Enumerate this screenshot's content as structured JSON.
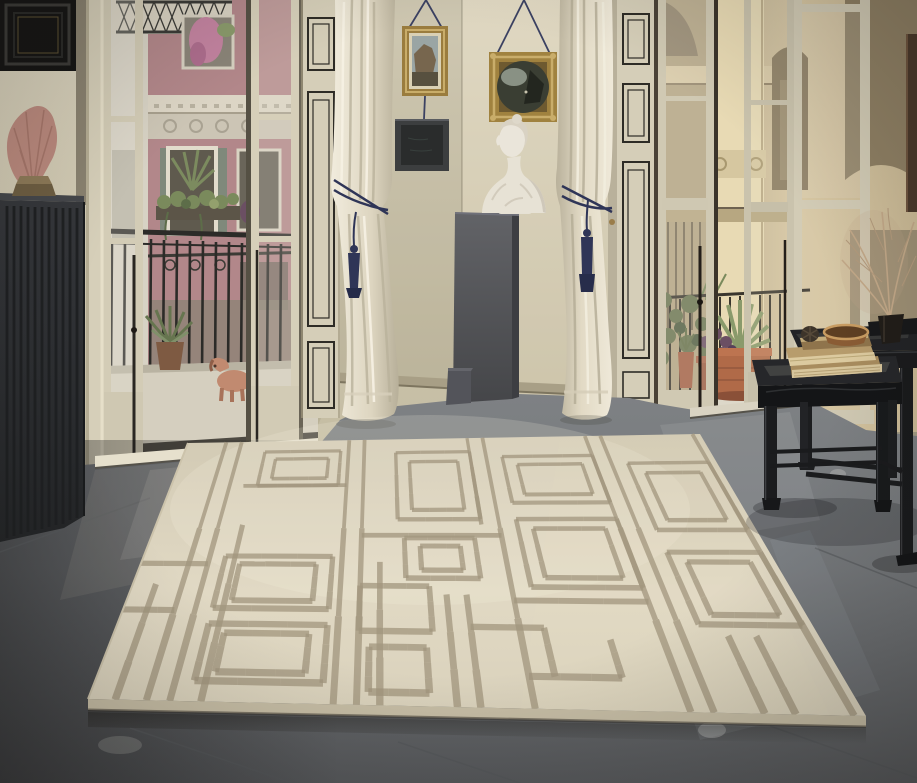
{
  "scene": {
    "description": "Sunlit historic apartment interior: tall open french doors reveal street balconies on the left (pink facade, plants, a ceramic dog figurine) and a baroque sandstone building on the right. A cream wool rug with a raised taupe architectural grid pattern lies on a polished grey stone floor. In the corner alcove, two gold-framed paintings and a dark plaque hang on cords above a white marble bust on a grey pedestal, flanked by ivory curtains tied with navy tassels. At right, black nesting side tables hold antique books, a wooden bowl and a dried sea-fan branch.",
    "objects": [
      "patterned cream rug",
      "polished grey stone floor",
      "french doors with black-trimmed cream panels",
      "ivory curtains with navy tassel tiebacks",
      "gold framed landscape painting",
      "gold framed round painting",
      "dark slate plaque",
      "white marble bust",
      "grey pedestal",
      "pink sea-fan coral on wood base",
      "dark ribbed sideboard",
      "black ornate picture frame",
      "street balcony with iron railing",
      "ceramic dog figurine",
      "terracotta planters with agave",
      "black nesting tables",
      "stack of antique books",
      "wooden bowl",
      "pinecone",
      "dried sea-fan branch in dark vase",
      "pink residential facade",
      "baroque sandstone facade"
    ]
  },
  "palette": {
    "wall": "#d5cdb5",
    "wallShade": "#bdb49a",
    "cream": "#d6cfb9",
    "creamLit": "#e5dfc9",
    "trim": "#2e2c26",
    "curtain": "#eee8d8",
    "curtainShade": "#c2ba a4",
    "navy": "#2f3557",
    "gold": "#9e8040",
    "goldLit": "#c9ad6a",
    "plaque": "#3c3e3f",
    "bust": "#eae5da",
    "pedestal": "#57585c",
    "cabinet": "#2f3133",
    "coral": "#bb8a7e",
    "woodBase": "#8d7a58",
    "floor": "#797c7f",
    "floorDark": "#595c5f",
    "seam": "#54575a",
    "rug": "#ddd5bf",
    "rugLine": "#a2967e",
    "rugEdge": "#c6bda5",
    "pink": "#b2878a",
    "stone": "#cdbd9b",
    "stoneLit": "#e8dab4",
    "stoneShade": "#a3926f",
    "foliage": "#6d7a55",
    "foliageDark": "#4f5d41",
    "iron": "#2c2b28",
    "balconyFloor": "#d5cfbf",
    "dog": "#c18a70",
    "terracotta": "#b06a48",
    "table": "#1b1c1e",
    "book": "#b79c6c",
    "pages": "#dcca9f",
    "branch": "#c2a888",
    "glass": "#e4dfd0"
  },
  "rug": {
    "corners": {
      "ax": 188,
      "ay": 443,
      "bx": 700,
      "by": 434,
      "cx": 88,
      "cy": 699,
      "dx": 866,
      "dy": 716
    },
    "segments": [
      {
        "l": [
          0.035,
          0.55,
          0.035,
          1
        ]
      },
      {
        "l": [
          0.075,
          0,
          0.075,
          1
        ]
      },
      {
        "l": [
          0.105,
          0,
          0.105,
          1
        ]
      },
      {
        "l": [
          0.145,
          0.32,
          0.145,
          1
        ]
      },
      {
        "l": [
          0.315,
          0,
          0.315,
          1
        ]
      },
      {
        "l": [
          0.345,
          0,
          0.345,
          1
        ]
      },
      {
        "l": [
          0.375,
          0.46,
          0.375,
          1
        ]
      },
      {
        "l": [
          0.545,
          0,
          0.545,
          0.32
        ]
      },
      {
        "l": [
          0.575,
          0,
          0.575,
          1
        ]
      },
      {
        "l": [
          0.775,
          0,
          0.775,
          1
        ]
      },
      {
        "l": [
          0.805,
          0,
          0.805,
          1
        ]
      },
      {
        "l": [
          0.985,
          0,
          0.985,
          1
        ]
      },
      {
        "l": [
          0.13,
          0.17,
          0.315,
          0.17
        ]
      },
      {
        "l": [
          0,
          0.47,
          0.105,
          0.47
        ]
      },
      {
        "l": [
          0,
          0.65,
          0.075,
          0.65
        ]
      },
      {
        "l": [
          0.345,
          0.36,
          0.575,
          0.36
        ]
      },
      {
        "l": [
          0.575,
          0.6,
          0.775,
          0.6
        ]
      },
      {
        "l": [
          0.475,
          0.58,
          0.475,
          1
        ]
      },
      {
        "l": [
          0.505,
          0.58,
          0.505,
          1
        ]
      },
      {
        "l": [
          0.505,
          0.7,
          0.61,
          0.7
        ]
      },
      {
        "l": [
          0.61,
          0.7,
          0.61,
          0.88
        ]
      },
      {
        "l": [
          0.575,
          0.88,
          0.7,
          0.88
        ]
      },
      {
        "l": [
          0.7,
          0.74,
          0.7,
          0.88
        ]
      },
      {
        "l": [
          0.87,
          0.72,
          0.87,
          1
        ]
      },
      {
        "l": [
          0.91,
          0.72,
          0.91,
          1
        ]
      },
      {
        "r": [
          0.155,
          0.04,
          0.3,
          0.17
        ]
      },
      {
        "r": [
          0.178,
          0.068,
          0.278,
          0.143
        ]
      },
      {
        "r": [
          0.405,
          0.05,
          0.545,
          0.3
        ]
      },
      {
        "r": [
          0.43,
          0.085,
          0.52,
          0.265
        ]
      },
      {
        "r": [
          0.415,
          0.37,
          0.53,
          0.52
        ]
      },
      {
        "r": [
          0.44,
          0.4,
          0.505,
          0.49
        ]
      },
      {
        "r": [
          0.13,
          0.44,
          0.3,
          0.64
        ]
      },
      {
        "r": [
          0.155,
          0.47,
          0.275,
          0.61
        ]
      },
      {
        "r": [
          0.13,
          0.7,
          0.3,
          0.92
        ]
      },
      {
        "r": [
          0.155,
          0.735,
          0.275,
          0.885
        ]
      },
      {
        "r": [
          0.605,
          0.07,
          0.775,
          0.24
        ]
      },
      {
        "r": [
          0.63,
          0.1,
          0.75,
          0.21
        ]
      },
      {
        "r": [
          0.605,
          0.3,
          0.775,
          0.55
        ]
      },
      {
        "r": [
          0.63,
          0.335,
          0.75,
          0.515
        ]
      },
      {
        "r": [
          0.835,
          0.1,
          0.985,
          0.34
        ]
      },
      {
        "r": [
          0.86,
          0.135,
          0.96,
          0.305
        ]
      },
      {
        "r": [
          0.835,
          0.42,
          0.985,
          0.68
        ]
      },
      {
        "r": [
          0.86,
          0.455,
          0.96,
          0.645
        ]
      },
      {
        "r": [
          0.345,
          0.55,
          0.45,
          0.72
        ]
      },
      {
        "r": [
          0.36,
          0.78,
          0.44,
          0.95
        ]
      }
    ]
  }
}
